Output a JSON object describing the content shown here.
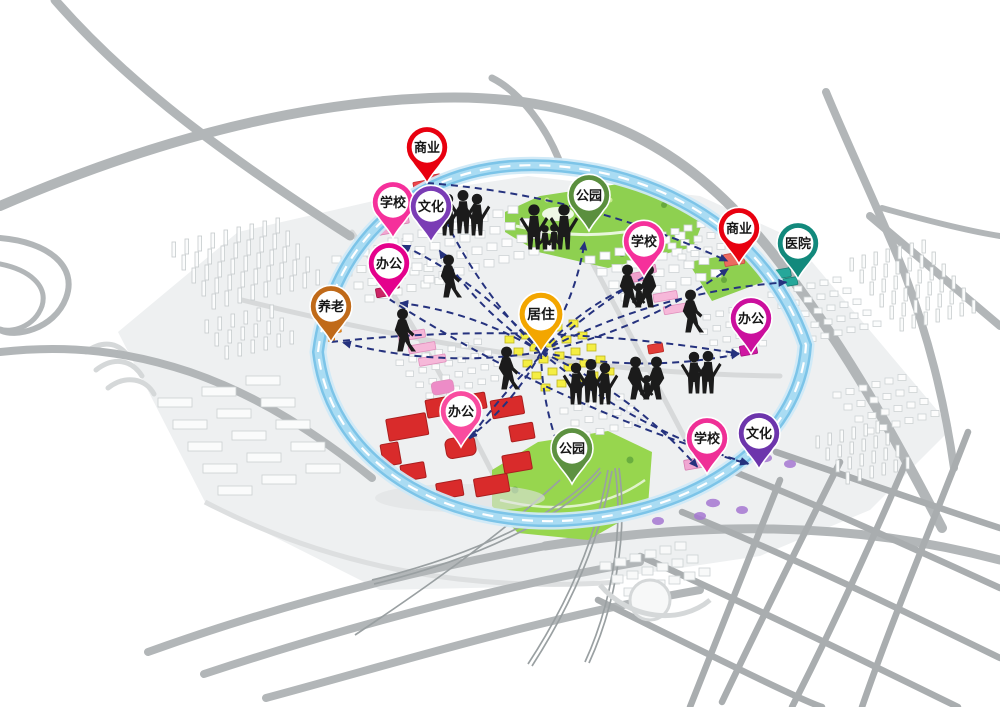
{
  "diagram": {
    "kind": "urban-planning-life-circle-map",
    "colors": {
      "ring_band": "#7cc4e8",
      "ring_core": "#aadcf3",
      "ring_dash": "#ffffff",
      "connector": "#25327e",
      "park_green": "#8ed050",
      "park_south_green": "#97d64e",
      "residential_yellow": "#f4ee43",
      "office_complex_red": "#d92b2b",
      "road_gray": "#b2b6b8"
    },
    "pins": [
      {
        "id": "commercial-nw",
        "label": "商业",
        "color": "#e8000f",
        "x": 427,
        "y": 183
      },
      {
        "id": "school-nw",
        "label": "学校",
        "color": "#f5309b",
        "x": 393,
        "y": 238
      },
      {
        "id": "culture-nw",
        "label": "文化",
        "color": "#7a3cb5",
        "x": 431,
        "y": 242
      },
      {
        "id": "office-nw",
        "label": "办公",
        "color": "#e4018c",
        "x": 389,
        "y": 299
      },
      {
        "id": "eldercare-w",
        "label": "养老",
        "color": "#c06a19",
        "x": 331,
        "y": 342
      },
      {
        "id": "park-n",
        "label": "公园",
        "color": "#5b8f3e",
        "x": 589,
        "y": 231
      },
      {
        "id": "school-ne",
        "label": "学校",
        "color": "#f5309b",
        "x": 644,
        "y": 277
      },
      {
        "id": "commercial-ne",
        "label": "商业",
        "color": "#e8000f",
        "x": 739,
        "y": 264
      },
      {
        "id": "hospital-e",
        "label": "医院",
        "color": "#12897c",
        "x": 798,
        "y": 279
      },
      {
        "id": "office-e",
        "label": "办公",
        "color": "#cb0f9d",
        "x": 751,
        "y": 354
      },
      {
        "id": "office-s",
        "label": "办公",
        "color": "#f94b9f",
        "x": 461,
        "y": 447
      },
      {
        "id": "park-s",
        "label": "公园",
        "color": "#5d9141",
        "x": 572,
        "y": 484
      },
      {
        "id": "school-s",
        "label": "学校",
        "color": "#ef2f96",
        "x": 707,
        "y": 474
      },
      {
        "id": "culture-s",
        "label": "文化",
        "color": "#6d35ac",
        "x": 759,
        "y": 469
      },
      {
        "id": "residence-center",
        "label": "居住",
        "color": "#f3a600",
        "x": 541,
        "y": 352,
        "hub": true
      }
    ],
    "connections": [
      {
        "from": "residence-center",
        "to": "commercial-nw"
      },
      {
        "from": "residence-center",
        "to": "school-nw"
      },
      {
        "from": "residence-center",
        "to": "culture-nw"
      },
      {
        "from": "residence-center",
        "to": "office-nw"
      },
      {
        "from": "residence-center",
        "to": "eldercare-w"
      },
      {
        "from": "residence-center",
        "to": "park-n"
      },
      {
        "from": "residence-center",
        "to": "school-ne"
      },
      {
        "from": "residence-center",
        "to": "commercial-ne"
      },
      {
        "from": "residence-center",
        "to": "hospital-e"
      },
      {
        "from": "residence-center",
        "to": "office-e"
      },
      {
        "from": "residence-center",
        "to": "office-s"
      },
      {
        "from": "residence-center",
        "to": "park-s"
      },
      {
        "from": "residence-center",
        "to": "school-s"
      },
      {
        "from": "residence-center",
        "to": "culture-s"
      },
      {
        "from": "commercial-nw",
        "to": "commercial-ne"
      },
      {
        "from": "office-nw",
        "to": "culture-s"
      },
      {
        "from": "eldercare-w",
        "to": "office-e"
      },
      {
        "from": "school-ne",
        "to": "office-s"
      }
    ],
    "figures": [
      {
        "name": "people-group-standing",
        "variant": "trio",
        "x": 462,
        "y": 236
      },
      {
        "name": "people-family",
        "variant": "family4",
        "x": 549,
        "y": 250
      },
      {
        "name": "people-family",
        "variant": "family3",
        "x": 638,
        "y": 308
      },
      {
        "name": "person-walking",
        "variant": "walk",
        "x": 690,
        "y": 333
      },
      {
        "name": "person-walking",
        "variant": "walk",
        "x": 448,
        "y": 298
      },
      {
        "name": "person-walking",
        "variant": "walk",
        "x": 402,
        "y": 352
      },
      {
        "name": "person-walking",
        "variant": "walk",
        "x": 506,
        "y": 390
      },
      {
        "name": "people-group-standing",
        "variant": "trio",
        "x": 590,
        "y": 405
      },
      {
        "name": "people-family",
        "variant": "family3",
        "x": 646,
        "y": 400
      },
      {
        "name": "people-pair-standing",
        "variant": "pair",
        "x": 701,
        "y": 394
      }
    ]
  }
}
